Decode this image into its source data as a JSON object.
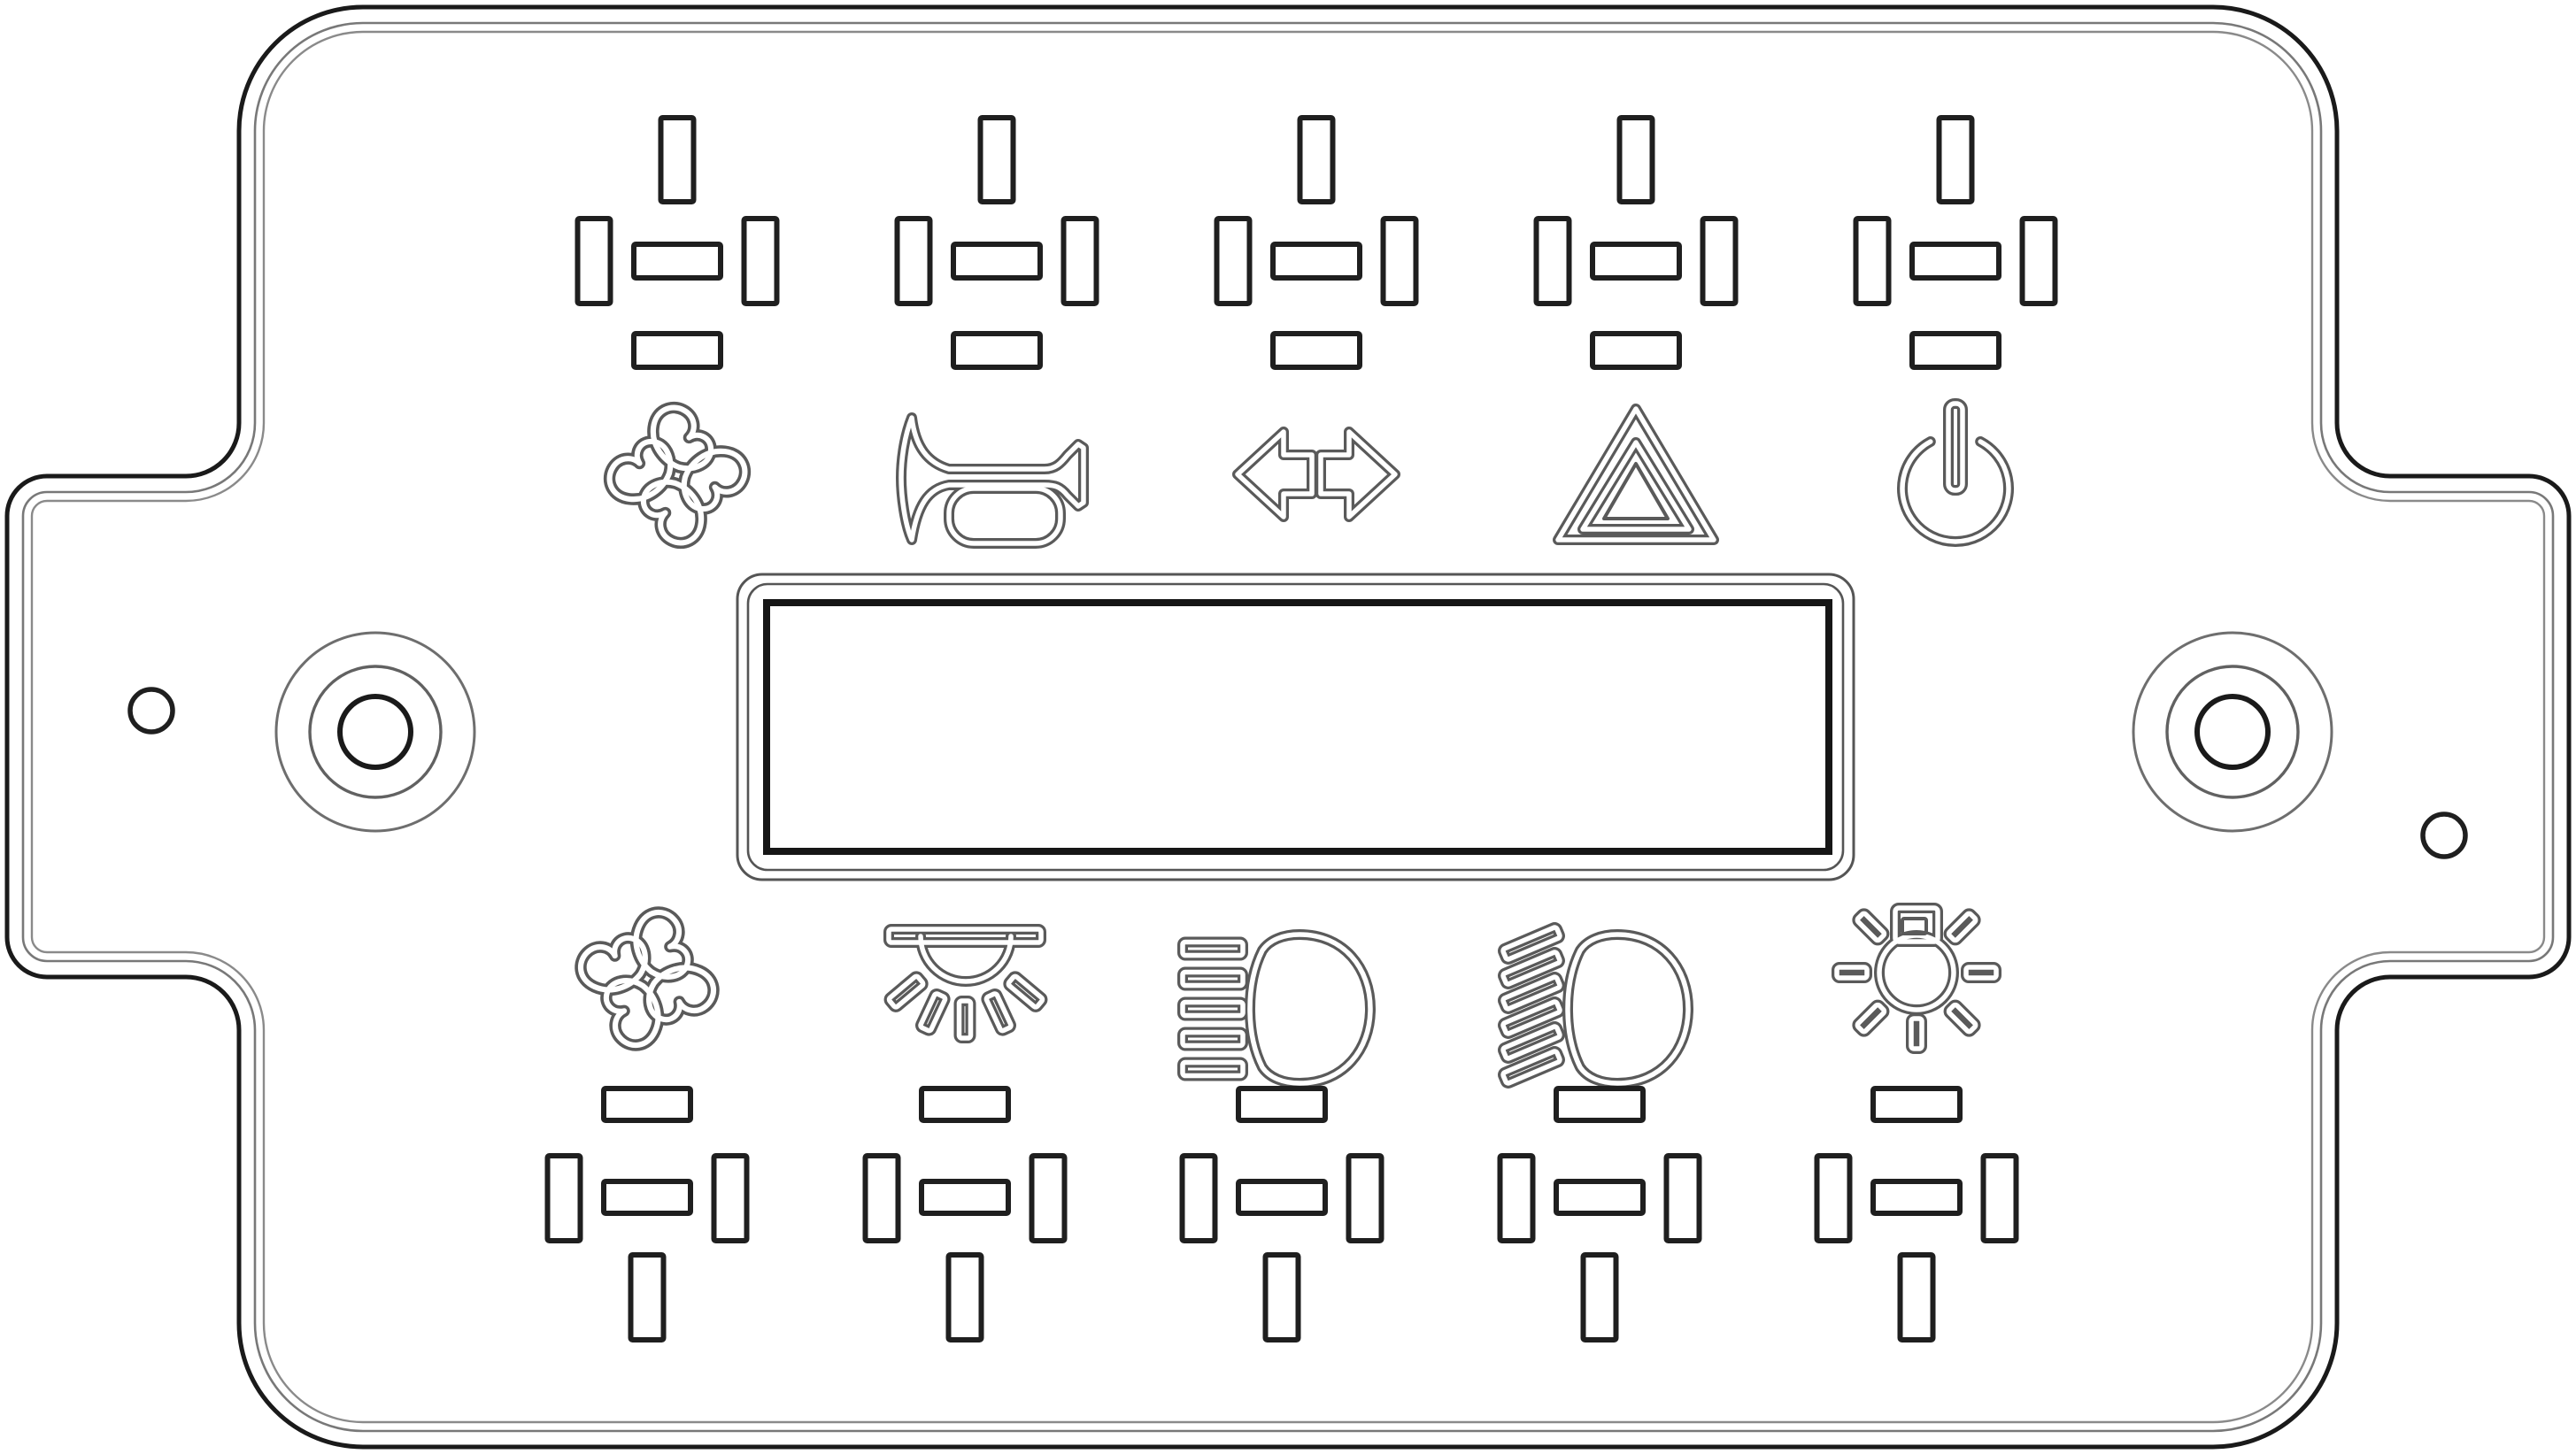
{
  "panel": {
    "name": "switch-panel-faceplate",
    "background_color": "#ffffff",
    "outline_color": "#1a1a1a",
    "engraving_color": "#5a5a5a",
    "slot_color": "#1f1f1f"
  },
  "display": {
    "label": "LCD display window"
  },
  "knobs": [
    {
      "label": "Left rotary knob"
    },
    {
      "label": "Right rotary knob"
    }
  ],
  "holes": [
    {
      "label": "Left indicator hole"
    },
    {
      "label": "Right indicator hole"
    }
  ],
  "top_buttons": [
    {
      "icon": "fan-icon",
      "label": "Fan switch"
    },
    {
      "icon": "horn-icon",
      "label": "Horn switch"
    },
    {
      "icon": "turn-signals-icon",
      "label": "Turn signal switch"
    },
    {
      "icon": "hazard-icon",
      "label": "Hazard warning switch"
    },
    {
      "icon": "power-icon",
      "label": "Power switch"
    }
  ],
  "bottom_buttons": [
    {
      "icon": "fan-icon",
      "label": "Fan switch"
    },
    {
      "icon": "dome-light-icon",
      "label": "Interior light switch"
    },
    {
      "icon": "high-beam-icon",
      "label": "High beam switch"
    },
    {
      "icon": "low-beam-icon",
      "label": "Low beam switch"
    },
    {
      "icon": "work-light-icon",
      "label": "Work light switch"
    }
  ]
}
